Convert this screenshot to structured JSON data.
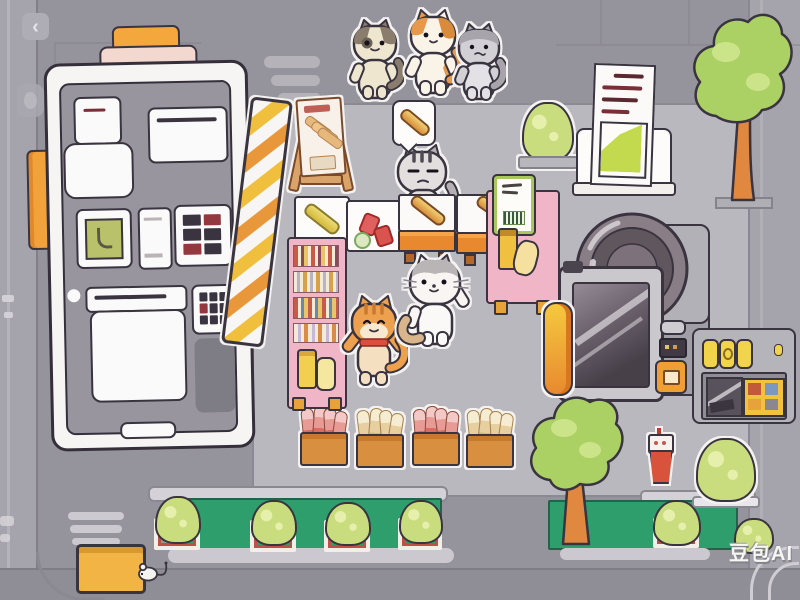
{
  "scene": {
    "title": "cat-bakery-top-down-scene",
    "watermark": "豆包AI",
    "back_glyph": "‹"
  },
  "palette": {
    "background": "#95939b",
    "floor": "#bab8bf",
    "outline": "#3a3440",
    "accent_orange": "#f2a23a",
    "counter_orange": "#e8892f",
    "pink": "#f0b6c8",
    "leaf_green": "#c9dd7e",
    "planter_green": "#2f9e6d",
    "chart_green": "#c3d94e",
    "yellow": "#f2d44a",
    "red": "#d94f3d"
  },
  "entities": {
    "characters": [
      "tabby-cat",
      "calico-cat",
      "gray-cat",
      "cashier-cat",
      "orange-cat",
      "white-cat",
      "mouse"
    ],
    "props": [
      "clipboard-tablet",
      "hazard-stripe-board",
      "menu-board",
      "speech-bubble-baguette",
      "bakery-counter",
      "pink-shelf",
      "pink-cart",
      "document-stand",
      "camera-machine",
      "yellow-capsule",
      "vending-kiosk",
      "food-crates",
      "planter-row",
      "trees",
      "drink-cup",
      "yellow-folder"
    ]
  }
}
